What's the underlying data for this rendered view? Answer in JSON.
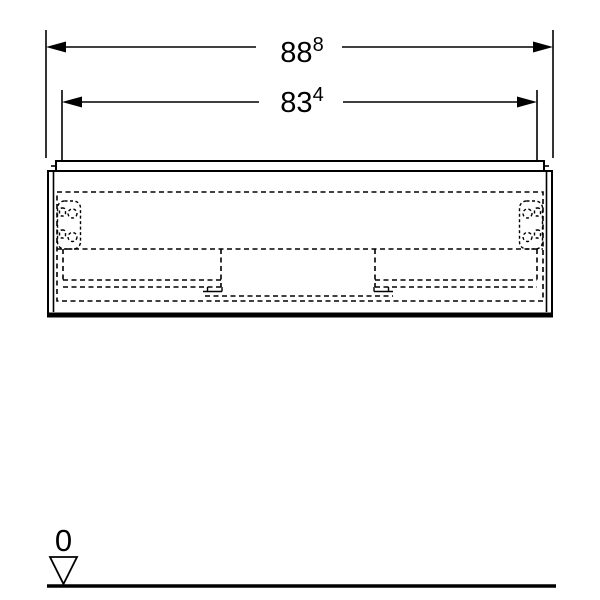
{
  "page": {
    "background_color": "#ffffff",
    "line_color": "#000000"
  },
  "drawing": {
    "kind": "technical-front-elevation-vanity-cabinet",
    "dimensions": [
      {
        "id": "outer-width",
        "value": "88",
        "superscript": "8"
      },
      {
        "id": "inner-width",
        "value": "83",
        "superscript": "4"
      }
    ],
    "datum": {
      "label": "0"
    }
  }
}
